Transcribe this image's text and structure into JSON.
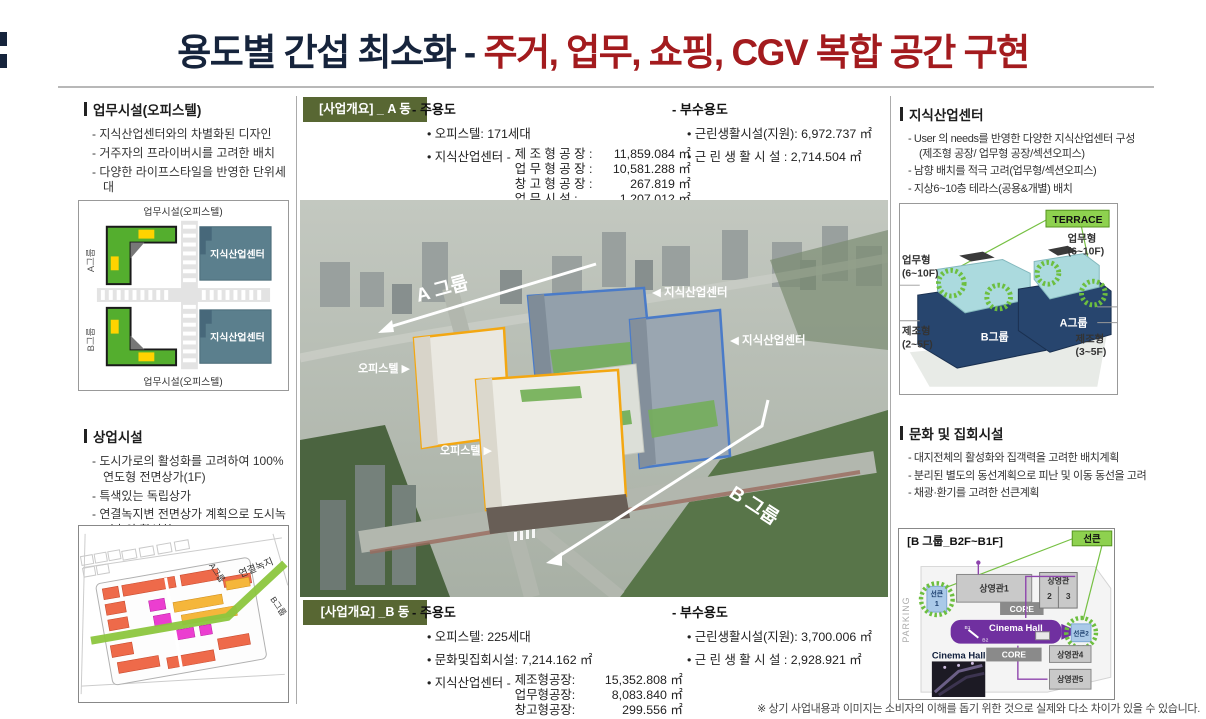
{
  "colors": {
    "title_navy": "#16243c",
    "title_red": "#a31b1e",
    "tag_olive": "#586733",
    "terrace_green": "#8ed14f",
    "outline_orange": "#f3a712",
    "outline_blue": "#4a7bc8",
    "building_navy": "#27456e",
    "building_cyan": "#abdade",
    "cinema_purple": "#7030a0"
  },
  "title": {
    "black_part": "용도별 간섭 최소화 - ",
    "red_part": "주거, 업무, 쇼핑, CGV 복합 공간 구현"
  },
  "left": {
    "office": {
      "title": "업무시설(오피스텔)",
      "bullets": [
        "- 지식산업센터와의 차별화된 디자인",
        "- 거주자의 프라이버시를 고려한 배치",
        "- 다양한 라이프스타일을 반영한 단위세대"
      ]
    },
    "block_diagram": {
      "top_label": "업무시설(오피스텔)",
      "bottom_label": "업무시설(오피스텔)",
      "group_a": "A그룹",
      "group_b": "B그룹",
      "kic_top": "지식산업센터",
      "kic_bottom": "지식산업센터"
    },
    "retail": {
      "title": "상업시설",
      "bullets": [
        "- 도시가로의 활성화를 고려하여 100%연도형 전면상가(1F)",
        "- 특색있는 독립상가",
        "- 연결녹지변 전면상가 계획으로 도시녹지축의 활성화"
      ]
    },
    "siteplan": {
      "group_a": "A그룹",
      "green_axis": "연결녹지",
      "group_b": "B그룹"
    }
  },
  "center": {
    "a": {
      "tag": "[사업개요] _ A 동",
      "main_title": "- 주용도",
      "unit": "• 오피스텔: 171세대",
      "kic_prefix": "• 지식산업센터 -",
      "rows": [
        {
          "label": "제 조 형 공 장 :",
          "value": "11,859.084 ㎡"
        },
        {
          "label": "업 무 형 공 장 :",
          "value": "10,581.288 ㎡"
        },
        {
          "label": "창 고 형 공 장 :",
          "value": "267.819 ㎡"
        },
        {
          "label": "업 무 시 설 :",
          "value": "1,207.012 ㎡"
        }
      ],
      "sub_title": "- 부수용도",
      "sub_items": [
        "• 근린생활시설(지원): 6,972.737 ㎡",
        "• 근 린 생 활 시 설 : 2,714.504 ㎡"
      ]
    },
    "render": {
      "group_a": "A 그룹",
      "group_b": "B 그룹",
      "kic_label_1": "◀ 지식산업센터",
      "kic_label_2": "◀ 지식산업센터",
      "officetel_1": "오피스텔 ▶",
      "officetel_2": "오피스텔 ▶"
    },
    "b": {
      "tag": "[사업개요] _B 동",
      "main_title": "- 주용도",
      "unit": "• 오피스텔: 225세대",
      "culture": "• 문화및집회시설: 7,214.162 ㎡",
      "kic_prefix": "• 지식산업센터 -",
      "rows": [
        {
          "label": "제조형공장:",
          "value": "15,352.808 ㎡"
        },
        {
          "label": "업무형공장:",
          "value": "8,083.840 ㎡"
        },
        {
          "label": "창고형공장:",
          "value": "299.556 ㎡"
        }
      ],
      "sub_title": "- 부수용도",
      "sub_items": [
        "• 근린생활시설(지원): 3,700.006 ㎡",
        "• 근 린 생 활 시 설 : 2,928.921 ㎡"
      ]
    }
  },
  "right": {
    "kic": {
      "title": "지식산업센터",
      "bullets": [
        "- User 의 needs를 반영한 다양한 지식산업센터 구성 (제조형 공장/ 업무형 공장/섹션오피스)",
        "- 남향 배치를 적극 고려(업무형/섹션오피스)",
        "- 지상6~10층 테라스(공용&개별) 배치"
      ]
    },
    "terrace": {
      "badge": "TERRACE",
      "office_left_1": "업무형",
      "office_left_2": "(6~10F)",
      "office_right_1": "업무형",
      "office_right_2": "(6~10F)",
      "mfg_left_1": "제조형",
      "mfg_left_2": "(2~5F)",
      "mfg_right_1": "제조형",
      "mfg_right_2": "(3~5F)",
      "group_b": "B그룹",
      "group_a": "A그룹"
    },
    "culture": {
      "title": "문화 및 집회시설",
      "bullets": [
        "- 대지전체의 활성화와 집객력을 고려한 배치계획",
        "- 분리된 별도의 동선계획으로 피난 및 이동 동선을 고려",
        "- 채광·환기를 고려한 선큰계획"
      ]
    },
    "cinema": {
      "title": "[B 그룹_B2F~B1F]",
      "sunken_badge": "선큰",
      "parking": "PARKING",
      "hall1": "상영관1",
      "core1": "CORE",
      "hall23_title": "상영관",
      "hall2": "2",
      "hall3": "3",
      "sunken1a": "선큰",
      "sunken1b": "1",
      "hall_corridor": "Cinema Hall",
      "b1": "B1",
      "b2": "B2",
      "sunken2": "선큰2",
      "hall4": "상영관4",
      "core2": "CORE",
      "hall5": "상영관5",
      "photo_label": "Cinema Hall"
    }
  },
  "footnote": "※ 상기 사업내용과 이미지는 소비자의 이해를 돕기 위한 것으로 실제와 다소 차이가 있을 수 있습니다."
}
